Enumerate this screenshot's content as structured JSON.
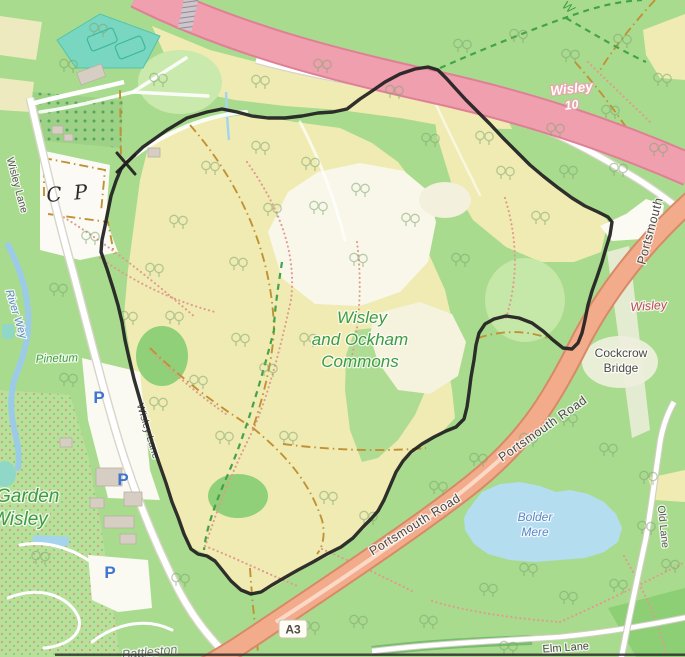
{
  "map": {
    "region_title": "Wisley and Ockham Commons",
    "labels": {
      "commons": [
        "Wisley",
        "and Ockham",
        "Commons"
      ],
      "motorway_name": "Wisley",
      "motorway_junction": "10",
      "portsmouth_road": "Portsmouth Road",
      "portsmouth_partial": "Portsmouth",
      "wisley_red": "Wisley",
      "cockcrow": [
        "Cockcrow",
        "Bridge"
      ],
      "bolder_mere": [
        "Bolder",
        "Mere"
      ],
      "old_lane": "Old Lane",
      "elm_lane": "Elm Lane",
      "a3_badge": "A3",
      "wisley_lane": "Wisley Lane",
      "river_wey": "River Wey",
      "pinetum": "Pinetum",
      "garden": [
        "Garden",
        "Wisley"
      ],
      "battleston": "Battleston",
      "handwritten_cp": "C P",
      "parking": "P",
      "partial_w": "W"
    },
    "colors": {
      "wood_green": "#a9db8e",
      "heath_yellow": "#f0ebb2",
      "motorway_pink": "#ef9fae",
      "trunk_salmon": "#f2ab8b",
      "water_blue": "#b5ddf0",
      "glasshouse_teal": "#79d6c0",
      "bridleway_ochre": "#c19135",
      "footpath_red": "#e09a8e",
      "label_green": "#3d9b40",
      "label_red": "#c04a57",
      "label_blue": "#5b87c7",
      "route_black": "#201e1f"
    },
    "route": {
      "color": "#201e1f",
      "width": 3.4,
      "points": [
        [
          126,
          163
        ],
        [
          143,
          147
        ],
        [
          167,
          130
        ],
        [
          187,
          118
        ],
        [
          207,
          112
        ],
        [
          222,
          109
        ],
        [
          237,
          112
        ],
        [
          252,
          116
        ],
        [
          268,
          118
        ],
        [
          285,
          118
        ],
        [
          302,
          116
        ],
        [
          318,
          113
        ],
        [
          333,
          112
        ],
        [
          347,
          109
        ],
        [
          360,
          99
        ],
        [
          372,
          91
        ],
        [
          385,
          82
        ],
        [
          400,
          74
        ],
        [
          415,
          69
        ],
        [
          428,
          67
        ],
        [
          438,
          70
        ],
        [
          446,
          78
        ],
        [
          455,
          88
        ],
        [
          466,
          100
        ],
        [
          478,
          112
        ],
        [
          490,
          124
        ],
        [
          503,
          138
        ],
        [
          517,
          152
        ],
        [
          530,
          165
        ],
        [
          543,
          176
        ],
        [
          557,
          187
        ],
        [
          572,
          198
        ],
        [
          585,
          206
        ],
        [
          598,
          212
        ],
        [
          608,
          217
        ],
        [
          612,
          222
        ],
        [
          610,
          235
        ],
        [
          606,
          248
        ],
        [
          602,
          262
        ],
        [
          597,
          277
        ],
        [
          592,
          291
        ],
        [
          588,
          305
        ],
        [
          585,
          320
        ],
        [
          582,
          333
        ],
        [
          578,
          343
        ],
        [
          572,
          349
        ],
        [
          563,
          348
        ],
        [
          553,
          340
        ],
        [
          543,
          331
        ],
        [
          532,
          323
        ],
        [
          519,
          318
        ],
        [
          506,
          316
        ],
        [
          494,
          319
        ],
        [
          485,
          324
        ],
        [
          479,
          333
        ],
        [
          476,
          345
        ],
        [
          474,
          360
        ],
        [
          471,
          377
        ],
        [
          469,
          393
        ],
        [
          467,
          407
        ],
        [
          464,
          419
        ],
        [
          456,
          427
        ],
        [
          446,
          431
        ],
        [
          434,
          437
        ],
        [
          422,
          444
        ],
        [
          411,
          452
        ],
        [
          403,
          461
        ],
        [
          396,
          472
        ],
        [
          390,
          486
        ],
        [
          384,
          500
        ],
        [
          378,
          511
        ],
        [
          371,
          519
        ],
        [
          363,
          527
        ],
        [
          353,
          538
        ],
        [
          341,
          547
        ],
        [
          327,
          554
        ],
        [
          313,
          562
        ],
        [
          298,
          570
        ],
        [
          284,
          578
        ],
        [
          272,
          585
        ],
        [
          261,
          592
        ],
        [
          251,
          594
        ],
        [
          241,
          590
        ],
        [
          231,
          581
        ],
        [
          223,
          571
        ],
        [
          215,
          561
        ],
        [
          207,
          556
        ],
        [
          198,
          554
        ],
        [
          191,
          549
        ],
        [
          184,
          534
        ],
        [
          178,
          517
        ],
        [
          172,
          502
        ],
        [
          166,
          483
        ],
        [
          159,
          463
        ],
        [
          152,
          442
        ],
        [
          146,
          421
        ],
        [
          140,
          400
        ],
        [
          134,
          379
        ],
        [
          129,
          358
        ],
        [
          125,
          340
        ],
        [
          122,
          322
        ],
        [
          118,
          305
        ],
        [
          113,
          288
        ],
        [
          107,
          269
        ],
        [
          101,
          252
        ],
        [
          102,
          240
        ],
        [
          105,
          226
        ],
        [
          108,
          211
        ],
        [
          111,
          196
        ],
        [
          116,
          181
        ],
        [
          121,
          169
        ],
        [
          126,
          163
        ]
      ]
    }
  }
}
